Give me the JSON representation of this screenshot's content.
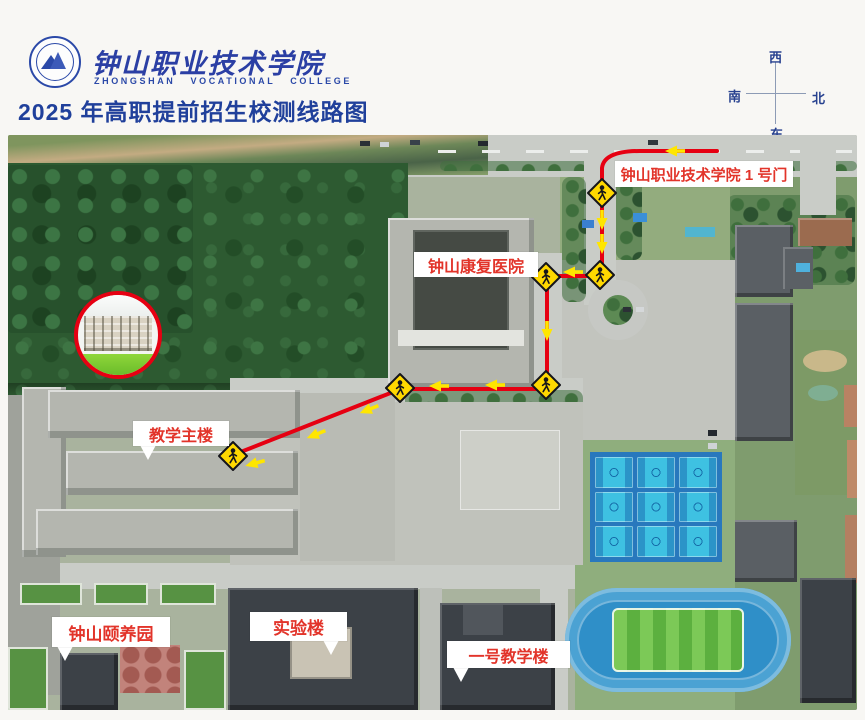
{
  "header": {
    "logo": {
      "name_zh": "钟山职业技术学院",
      "name_en": "ZHONGSHAN VOCATIONAL COLLEGE"
    },
    "title": "2025 年高职提前招生校测线路图"
  },
  "compass": {
    "top": "西",
    "left": "南",
    "right": "北",
    "bottom": "东"
  },
  "map": {
    "labels": {
      "gate1": "钟山职业技术学院 1 号门",
      "hospital": "钟山康复医院",
      "main_building": "教学主楼",
      "nursing_garden": "钟山颐养园",
      "lab_building": "实验楼",
      "teaching_building_1": "一号教学楼"
    },
    "colors": {
      "route": "#e60012",
      "arrow": "#ffe600",
      "crossing_sign_fill": "#ffd800",
      "crossing_sign_stroke": "#15151a",
      "label_text": "#e2342a"
    }
  }
}
